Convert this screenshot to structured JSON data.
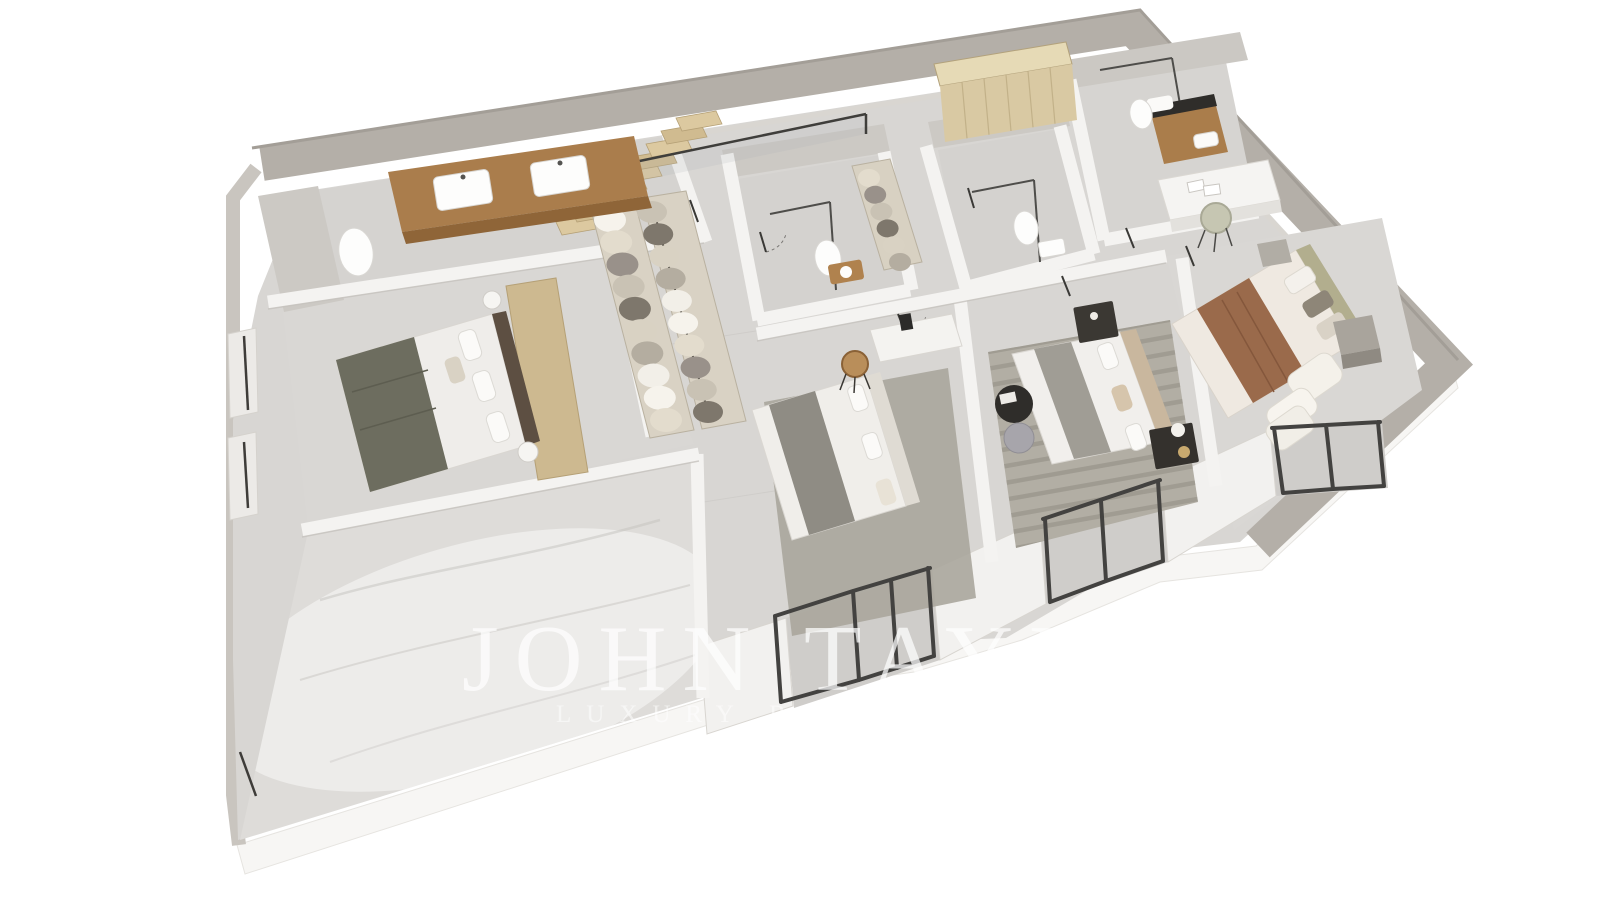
{
  "watermark": {
    "line1": "JOHN TAYLOR",
    "line2": "LUXURY REAL ESTATE"
  },
  "palette": {
    "background": "#ffffff",
    "outer_wall": "#b4afa8",
    "outer_wall_edge": "#a39e97",
    "wall_inner_highlight": "#d9d6d1",
    "wall_white": "#f4f3f1",
    "wall_cap": "#c6c3be",
    "skirt": "#f7f6f4",
    "floor_marble": "#d8d6d3",
    "floor_bath": "#d5d3d0",
    "floor_concrete": "#dedcd9",
    "terrace": "#cfcdca",
    "marble_wall": "#ccc9c4",
    "wood_vanity": "#aa7d4c",
    "wood_vanity_shadow": "#8f6538",
    "wood_stairs": "#dcc9a0",
    "wood_stairs_dark": "#d0bb90",
    "wood_platform": "#cdb990",
    "wardrobe_wood_top": "#e6dab6",
    "wardrobe_wood_front": "#d9c9a3",
    "wardrobe_seam": "#c2b189",
    "closet_frame": "#d9d2c4",
    "closet_rail": "#57524a",
    "closet_clothes": [
      "#f6f3ec",
      "#e3dccd",
      "#99918a",
      "#c9c2b4",
      "#7e776c",
      "#d9d2c3",
      "#b4ada0",
      "#f2efe8"
    ],
    "bed_white": "#f0eeea",
    "bed_blanket_olive": "#6d6d5f",
    "bed_blanket_gray": "#8f8c84",
    "bed_throw_brown": "#9a6a4b",
    "headboard_dark": "#5d4f42",
    "headboard_beige": "#c9b79e",
    "headboard_olive": "#b2ae8e",
    "rug_gray": "#aaa69c",
    "rug_striped_base": "#b2aea4",
    "rug_stripe": "#8e8a80",
    "furniture_dark": "#37342f",
    "chair_wood": "#b98e5a",
    "window_frame": "#434240",
    "glass_tint": "#aab4b8",
    "watermark_white": "#ffffff"
  }
}
